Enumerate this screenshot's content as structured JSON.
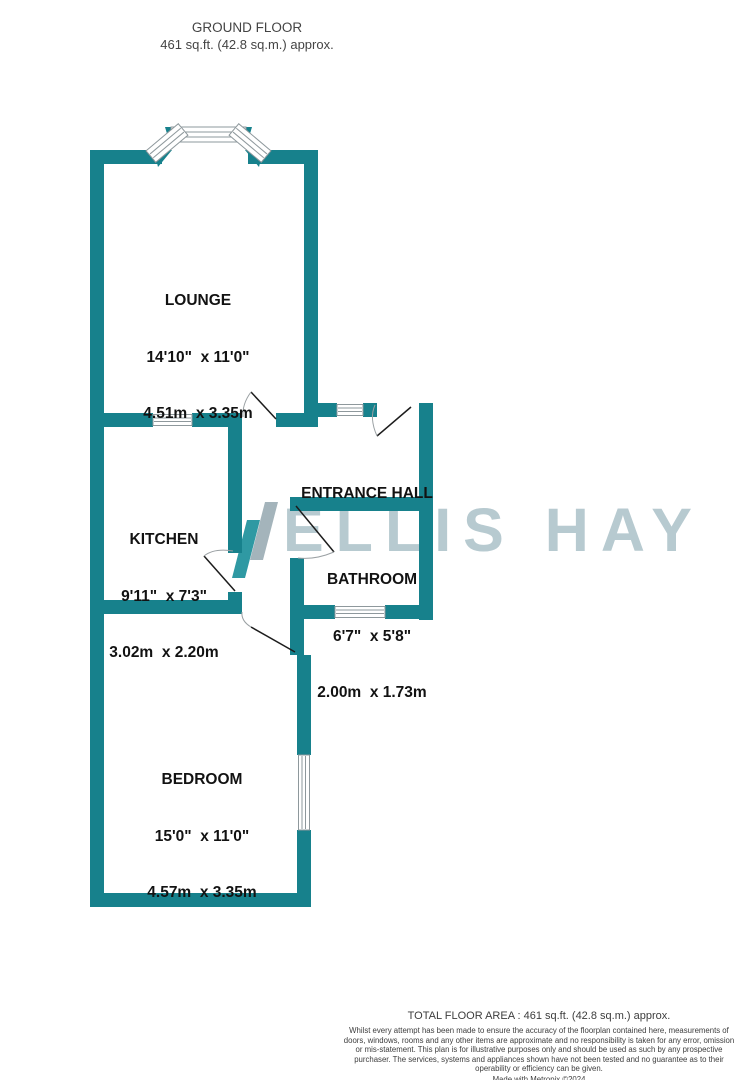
{
  "header": {
    "title": "GROUND FLOOR",
    "subtitle": "461 sq.ft. (42.8 sq.m.) approx."
  },
  "watermark": {
    "text": "ELLIS HAY"
  },
  "rooms": [
    {
      "id": "lounge",
      "name": "LOUNGE",
      "dims_imperial": "14'10\"  x 11'0\"",
      "dims_metric": "4.51m  x 3.35m"
    },
    {
      "id": "kitchen",
      "name": "KITCHEN",
      "dims_imperial": "9'11\"  x 7'3\"",
      "dims_metric": "3.02m  x 2.20m"
    },
    {
      "id": "entrance-hall",
      "name": "ENTRANCE HALL"
    },
    {
      "id": "bathroom",
      "name": "BATHROOM",
      "dims_imperial": "6'7\"  x 5'8\"",
      "dims_metric": "2.00m  x 1.73m"
    },
    {
      "id": "bedroom",
      "name": "BEDROOM",
      "dims_imperial": "15'0\"  x 11'0\"",
      "dims_metric": "4.57m  x 3.35m"
    }
  ],
  "footer": {
    "total_area": "TOTAL FLOOR AREA : 461 sq.ft. (42.8 sq.m.) approx.",
    "disclaimer": "Whilst every attempt has been made to ensure the accuracy of the floorplan contained here, measurements of doors, windows, rooms and any other items are approximate and no responsibility is taken for any error, omission or mis-statement. This plan is for illustrative purposes only and should be used as such by any prospective purchaser. The services, systems and appliances shown have not been tested and no guarantee as to their operability or efficiency can be given.",
    "credit": "Made with Metropix ©2024"
  },
  "colors": {
    "wall": "#17818C",
    "window_stroke": "#8e989c",
    "door_leaf": "#1c1c1c",
    "door_arc": "#9aa0a3",
    "wm_slash_teal": "#2f99a3",
    "wm_slash_gray": "#a4b4bb",
    "wm_text": "#b7cad0",
    "label_text": "#121212",
    "muted_text": "#444444"
  }
}
